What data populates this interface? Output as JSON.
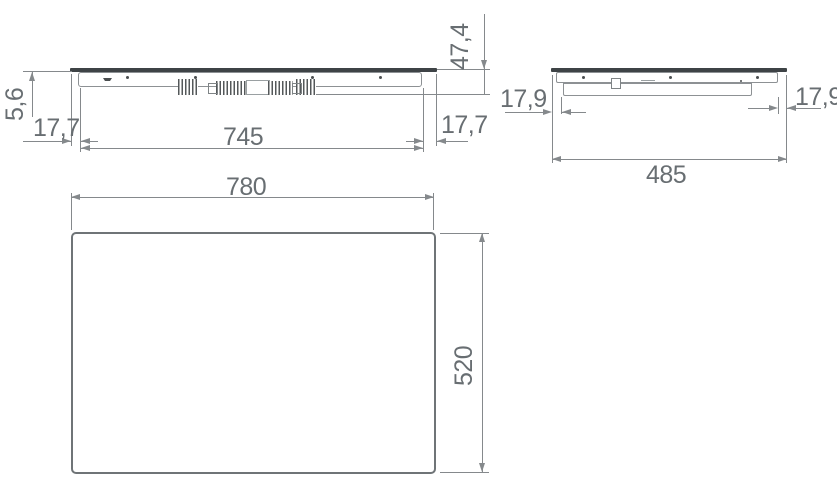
{
  "front_view": {
    "title": "front elevation",
    "glass_thickness": "5,6",
    "overhang_left": "17,7",
    "overhang_right": "17,7",
    "body_width": "745",
    "total_height": "47,4"
  },
  "side_view": {
    "title": "side elevation",
    "overhang_left": "17,9",
    "overhang_right": "17,9",
    "glass_width": "485"
  },
  "plan_view": {
    "title": "plan view",
    "width": "780",
    "depth": "520"
  },
  "colors": {
    "dimension_line": "#85898c",
    "glass_panel": "#3e4346",
    "dimension_text": "#686e72"
  }
}
